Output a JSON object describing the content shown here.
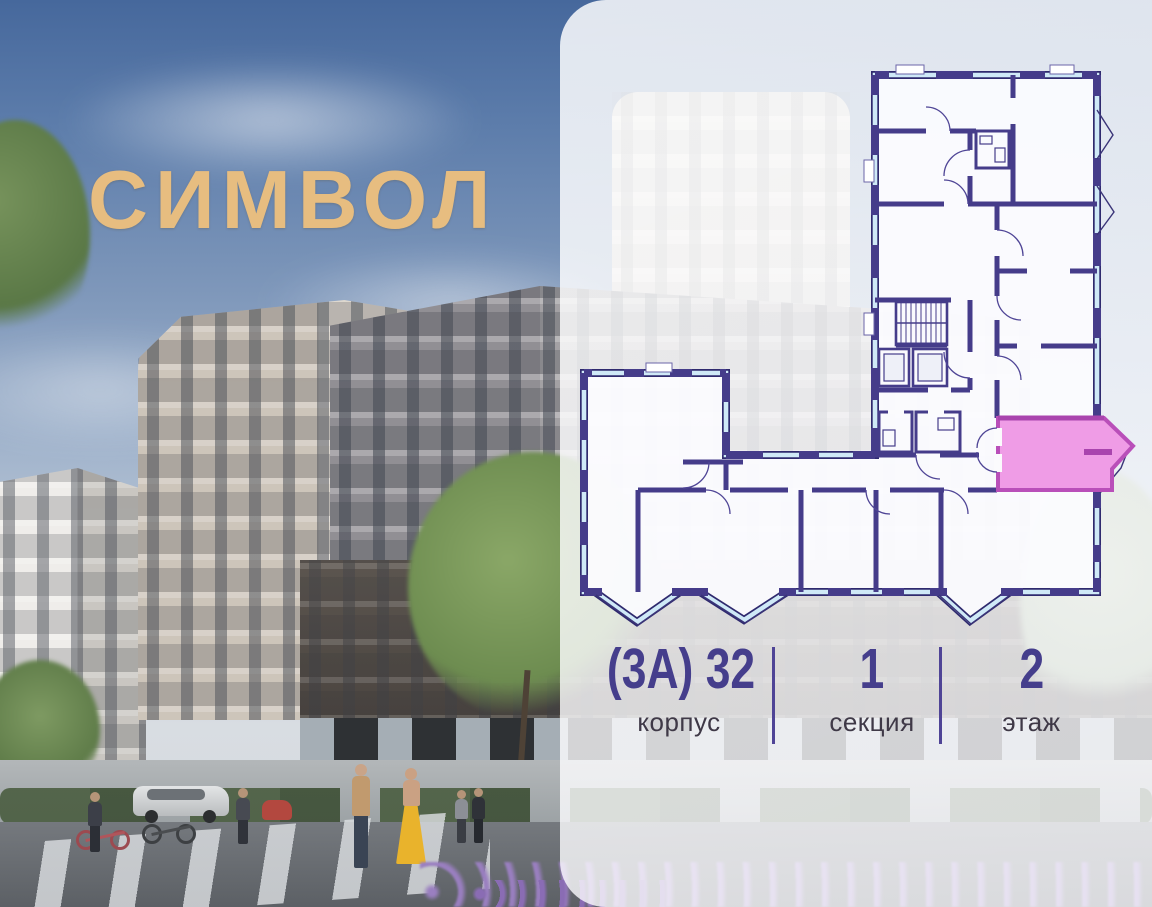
{
  "logo": {
    "text": "СИМВОЛ",
    "color": "#E7BD80"
  },
  "info": {
    "items": [
      {
        "value": "(3А) 32",
        "label": "корпус"
      },
      {
        "value": "1",
        "label": "секция"
      },
      {
        "value": "2",
        "label": "этаж"
      }
    ],
    "number_color": "#453E8C",
    "label_color": "#3F3947",
    "divider_color": "#4F4496"
  },
  "floorplan": {
    "wall_color": "#453C8A",
    "glazing_color": "#CFE9F7",
    "selected_unit_fill": "#EF9CE6",
    "selected_unit_border": "#B94FB9"
  }
}
